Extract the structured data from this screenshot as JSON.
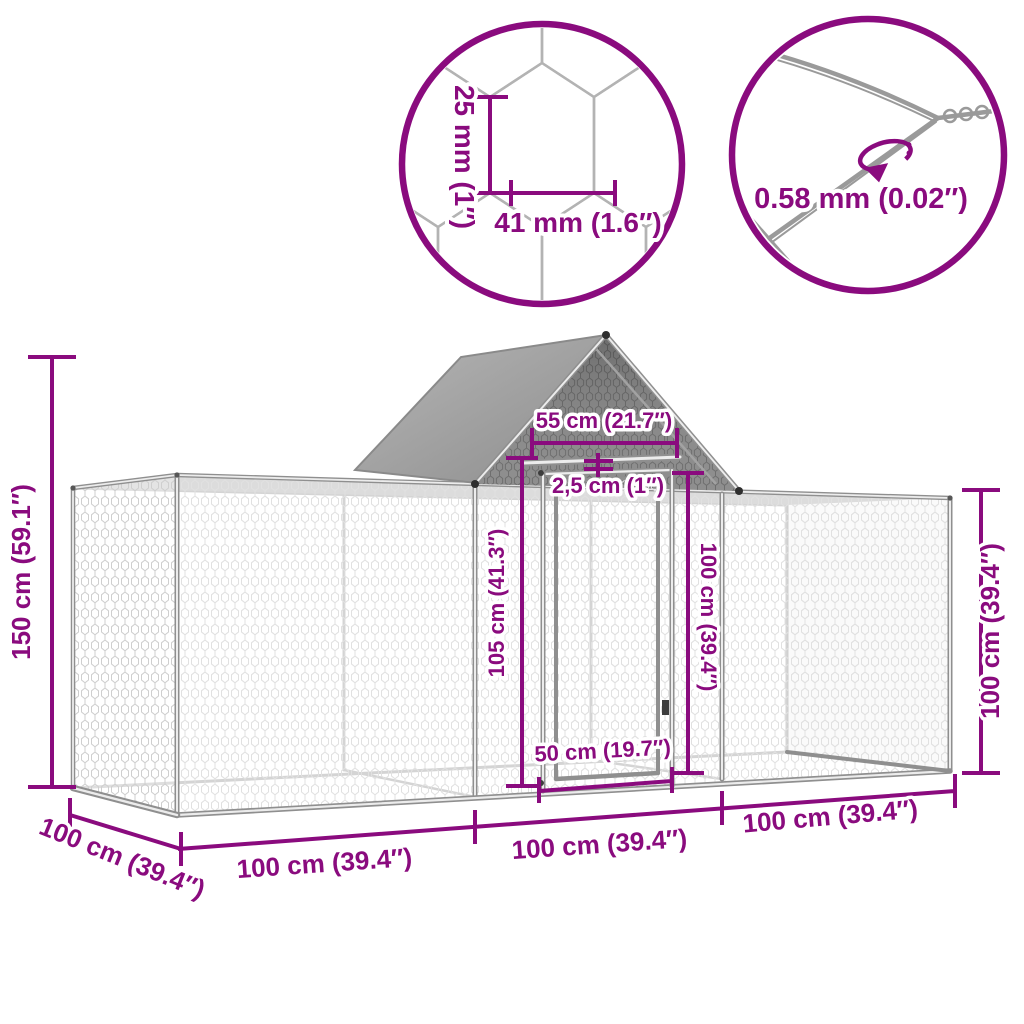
{
  "diagram_title": "chicken-coop-dimension-diagram",
  "colors": {
    "accent": "#8A0B7E",
    "frame_gray": "#8f8f8f",
    "tarp_gray": "#a0a0a0",
    "gable_mesh_gray": "#7f7f7f"
  },
  "detail_circles": {
    "mesh": {
      "name": "hexagonal-wire-mesh-detail",
      "cell_height_label": "25 mm (1″)",
      "cell_width_label": "41 mm (1.6″)"
    },
    "wire": {
      "name": "wire-thickness-detail",
      "diameter_label": "0.58 mm (0.02″)"
    }
  },
  "dimensions": {
    "total_height": "150 cm (59.1″)",
    "roof_base_width": "55 cm (21.7″)",
    "tube_thickness": "2,5 cm (1″)",
    "door_frame_height": "105 cm (41.3″)",
    "door_height": "100 cm (39.4″)",
    "door_width": "50 cm (19.7″)",
    "wall_height": "100 cm (39.4″)",
    "depth": "100 cm (39.4″)",
    "section1_width": "100 cm (39.4″)",
    "section2_width": "100 cm (39.4″)",
    "section3_width": "100 cm (39.4″)"
  }
}
